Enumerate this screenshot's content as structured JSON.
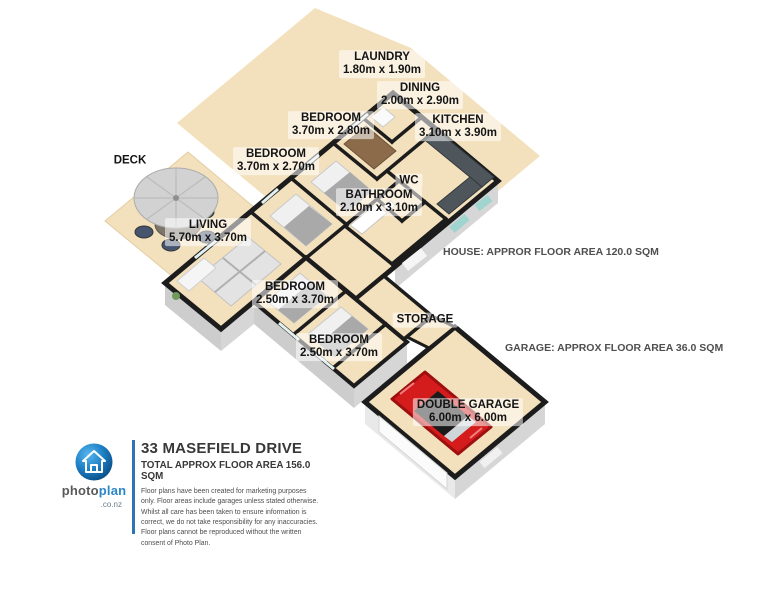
{
  "plan": {
    "rooms": [
      {
        "id": "laundry",
        "name": "LAUNDRY",
        "dims": "1.80m x 1.90m"
      },
      {
        "id": "dining",
        "name": "DINING",
        "dims": "2.00m x 2.90m"
      },
      {
        "id": "kitchen",
        "name": "KITCHEN",
        "dims": "3.10m x 3.90m"
      },
      {
        "id": "bedroom-top",
        "name": "BEDROOM",
        "dims": "3.70m x 2.80m"
      },
      {
        "id": "bedroom-mid",
        "name": "BEDROOM",
        "dims": "3.70m x 2.70m"
      },
      {
        "id": "wc",
        "name": "WC",
        "dims": ""
      },
      {
        "id": "bathroom",
        "name": "BATHROOM",
        "dims": "2.10m x 3.10m"
      },
      {
        "id": "living",
        "name": "LIVING",
        "dims": "5.70m x 3.70m"
      },
      {
        "id": "bedroom-wing-1",
        "name": "BEDROOM",
        "dims": "2.50m x 3.70m"
      },
      {
        "id": "storage",
        "name": "STORAGE",
        "dims": ""
      },
      {
        "id": "bedroom-wing-2",
        "name": "BEDROOM",
        "dims": "2.50m x 3.70m"
      },
      {
        "id": "double-garage",
        "name": "DOUBLE GARAGE",
        "dims": "6.00m x 6.00m"
      },
      {
        "id": "deck",
        "name": "DECK",
        "dims": ""
      }
    ],
    "annotations": {
      "house_area": "HOUSE: APPROR FLOOR AREA 120.0 SQM",
      "garage_area": "GARAGE: APPROX FLOOR AREA 36.0 SQM"
    }
  },
  "info": {
    "address": "33 MASEFIELD DRIVE",
    "total_area": "TOTAL APPROX FLOOR AREA 156.0 SQM",
    "disclaimer": "Floor plans have been created for marketing purposes only. Floor areas include garages unless stated otherwise. Whilst all care has been taken to ensure information is correct, we do not take responsibility for any inaccuracies. Floor plans cannot be reproduced without the written consent of Photo Plan.",
    "brand": {
      "part1": "photo",
      "part2": "plan",
      "suffix": ".co.nz"
    }
  },
  "colors": {
    "floor_tan": "#f3e1bd",
    "wall": "#1c1c1c",
    "wall_face": "#d4d4d4",
    "brand_blue": "#2e75b6",
    "logo_blue": "#2b87c8",
    "car_red": "#d41c1c",
    "window_teal": "#9fd4cf"
  }
}
